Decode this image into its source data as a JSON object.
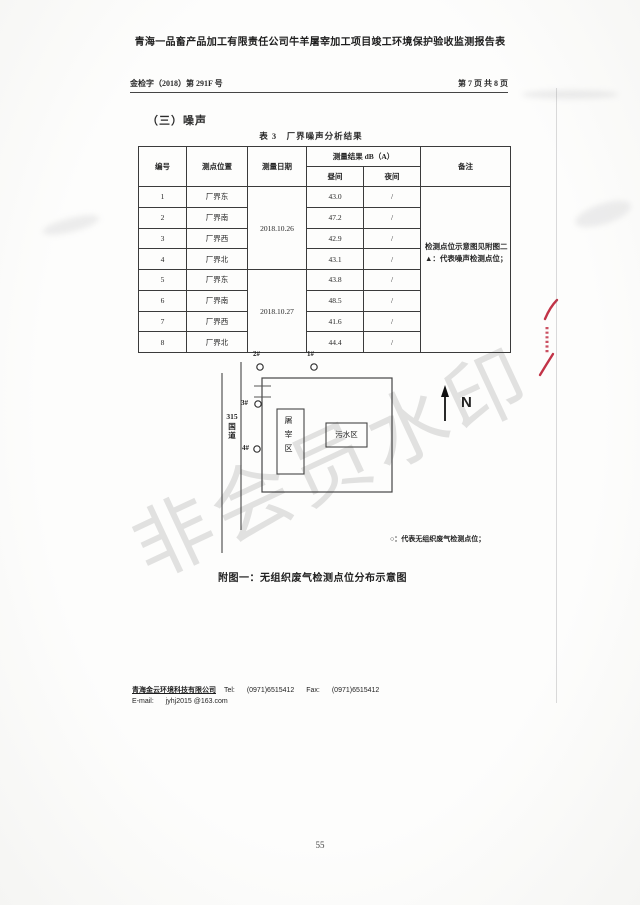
{
  "page": {
    "title": "青海一品畜产品加工有限责任公司牛羊屠宰加工项目竣工环境保护验收监测报告表",
    "doc_number": "金检字（2018）第 291F 号",
    "page_info": "第 7 页 共 8 页",
    "page_number": "55",
    "watermark": "非会员水印"
  },
  "section": {
    "heading": "（三）噪声",
    "table_caption": "表 3　厂界噪声分析结果"
  },
  "table": {
    "headers": {
      "id": "编号",
      "location": "测点位置",
      "date": "测量日期",
      "result_group": "测量结果 dB（A）",
      "day": "昼间",
      "night": "夜间",
      "remark": "备注"
    },
    "date_groups": [
      "2018.10.26",
      "2018.10.27"
    ],
    "remark_lines": [
      "检测点位示意图见附图二",
      "▲：代表噪声检测点位；"
    ],
    "rows": [
      {
        "id": "1",
        "location": "厂界东",
        "day": "43.0",
        "night": "/"
      },
      {
        "id": "2",
        "location": "厂界南",
        "day": "47.2",
        "night": "/"
      },
      {
        "id": "3",
        "location": "厂界西",
        "day": "42.9",
        "night": "/"
      },
      {
        "id": "4",
        "location": "厂界北",
        "day": "43.1",
        "night": "/"
      },
      {
        "id": "5",
        "location": "厂界东",
        "day": "43.8",
        "night": "/"
      },
      {
        "id": "6",
        "location": "厂界南",
        "day": "48.5",
        "night": "/"
      },
      {
        "id": "7",
        "location": "厂界西",
        "day": "41.6",
        "night": "/"
      },
      {
        "id": "8",
        "location": "厂界北",
        "day": "44.4",
        "night": "/"
      }
    ]
  },
  "diagram": {
    "points": [
      {
        "label": "2#"
      },
      {
        "label": "1#"
      },
      {
        "label": "3#"
      },
      {
        "label": "4#"
      }
    ],
    "road_lines": [
      "315",
      "国",
      "道"
    ],
    "slaughter_label": "屠宰区",
    "sewage_label": "污水区",
    "north_label": "N",
    "legend": "○：代表无组织废气检测点位；",
    "caption": "附图一：无组织废气检测点位分布示意图"
  },
  "footer": {
    "company": "青海金云环境科技有限公司",
    "tel_label": "Tel:",
    "tel": "(0971)6515412",
    "fax_label": "Fax:",
    "fax": "(0971)6515412",
    "email_label": "E-mail:",
    "email": "jyhj2015 @163.com"
  },
  "colors": {
    "ink": "#2b2b2b",
    "seal_red": "#c23347",
    "watermark_gray": "#d6d6d6"
  }
}
